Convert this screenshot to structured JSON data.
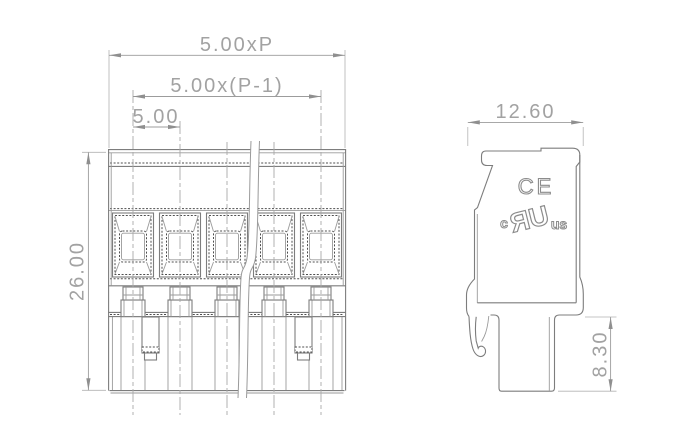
{
  "drawing": {
    "poles_shown": 5,
    "views_shown": 2
  },
  "front_view": {
    "dim_total_width": "5.00xP",
    "dim_span": "5.00x(P-1)",
    "dim_pitch": "5.00",
    "dim_height": "26.00"
  },
  "side_view": {
    "dim_depth": "12.60",
    "dim_pin_length": "8.30",
    "marks": {
      "ce": "CE",
      "ul_prefix": "c",
      "ul_logo": "UR",
      "ul_suffix": "us"
    }
  },
  "colors": {
    "background": "#ffffff",
    "outline": "#7d7d7d",
    "dark_hatch": "#4f4f4f",
    "dimension": "#9c9c9c",
    "dimension_text": "#a2a2a2"
  }
}
